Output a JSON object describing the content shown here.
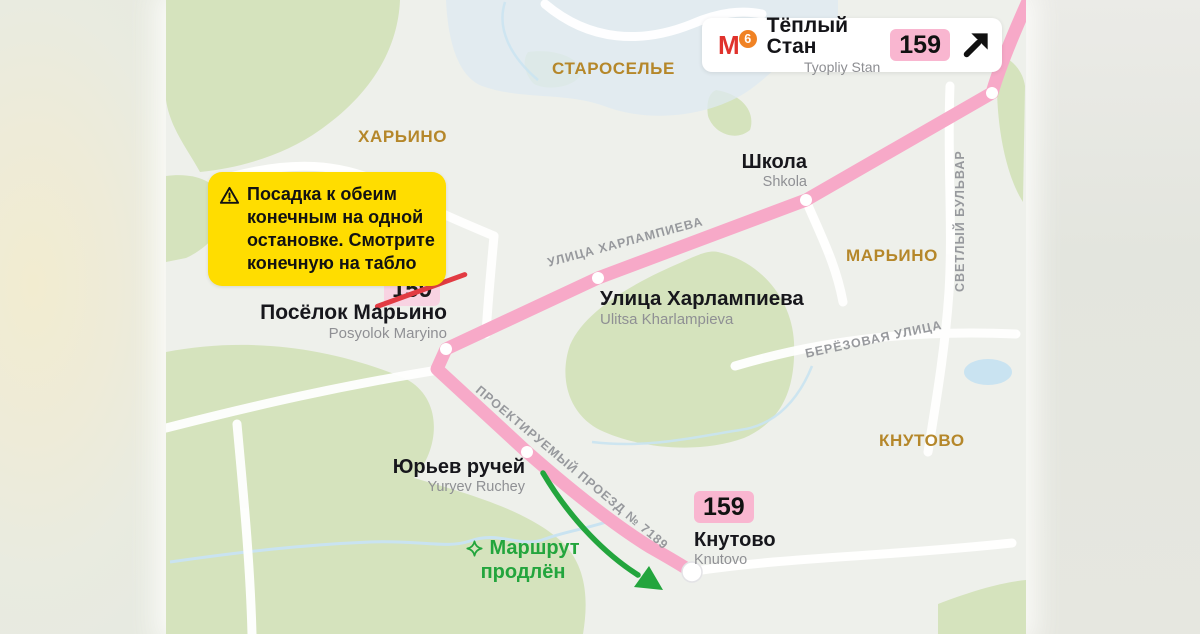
{
  "header_card": {
    "metro_letter": "М",
    "metro_line_number": "6",
    "station_name": "Тёплый Стан",
    "station_translit": "Tyopliy Stan",
    "route_badge": "159"
  },
  "warning_box": {
    "lines": [
      "Посадка к обеим",
      "конечным на одной",
      "остановке. Смотрите",
      "конечную на табло"
    ]
  },
  "districts": {
    "staroselye": "СТАРОСЕЛЬЕ",
    "kharino": "ХАРЬИНО",
    "maryino": "МАРЬИНО",
    "knutovo": "КНУТОВО"
  },
  "streets": {
    "kharlampieva": "УЛИЦА ХАРЛАМПИЕВА",
    "svetly_bulvar": "СВЕТЛЫЙ БУЛЬВАР",
    "beryozovaya": "БЕРЁЗОВАЯ УЛИЦА",
    "proyektiruemy": "ПРОЕКТИРУЕМЫЙ ПРОЕЗД № 7189"
  },
  "stops": {
    "shkola": {
      "name": "Школа",
      "translit": "Shkola"
    },
    "kharlampieva": {
      "name": "Улица Харлампиева",
      "translit": "Ulitsa Kharlampieva"
    },
    "posyolok_maryino": {
      "name": "Посёлок Марьино",
      "translit": "Posyolok Maryino",
      "old_badge": "159"
    },
    "yuryev_ruchey": {
      "name": "Юрьев ручей",
      "translit": "Yuryev Ruchey"
    },
    "knutovo": {
      "name": "Кнутово",
      "translit": "Knutovo",
      "badge": "159"
    }
  },
  "annotation": {
    "line1": "Маршрут",
    "line2": "продлён"
  },
  "icons": {
    "metro_logo": "metro-m-icon",
    "metro_arrow": "arrow-up-right-icon",
    "warning": "warning-triangle-icon",
    "annotation": "sparkle-icon"
  },
  "colors": {
    "route_pink": "#f7a9c8",
    "badge_pink": "#f9b6d0",
    "crossed_badge_pink": "#f8d3e2",
    "strike_red": "#e23b43",
    "warning_yellow": "#ffdd00",
    "accent_green": "#23a53d",
    "district_brown": "#b5872a",
    "street_gray": "#97999d",
    "metro_red": "#e0322c",
    "line6_orange": "#f08224",
    "map_green": "#d5e3bd",
    "water_blue": "#c9e3f1"
  }
}
